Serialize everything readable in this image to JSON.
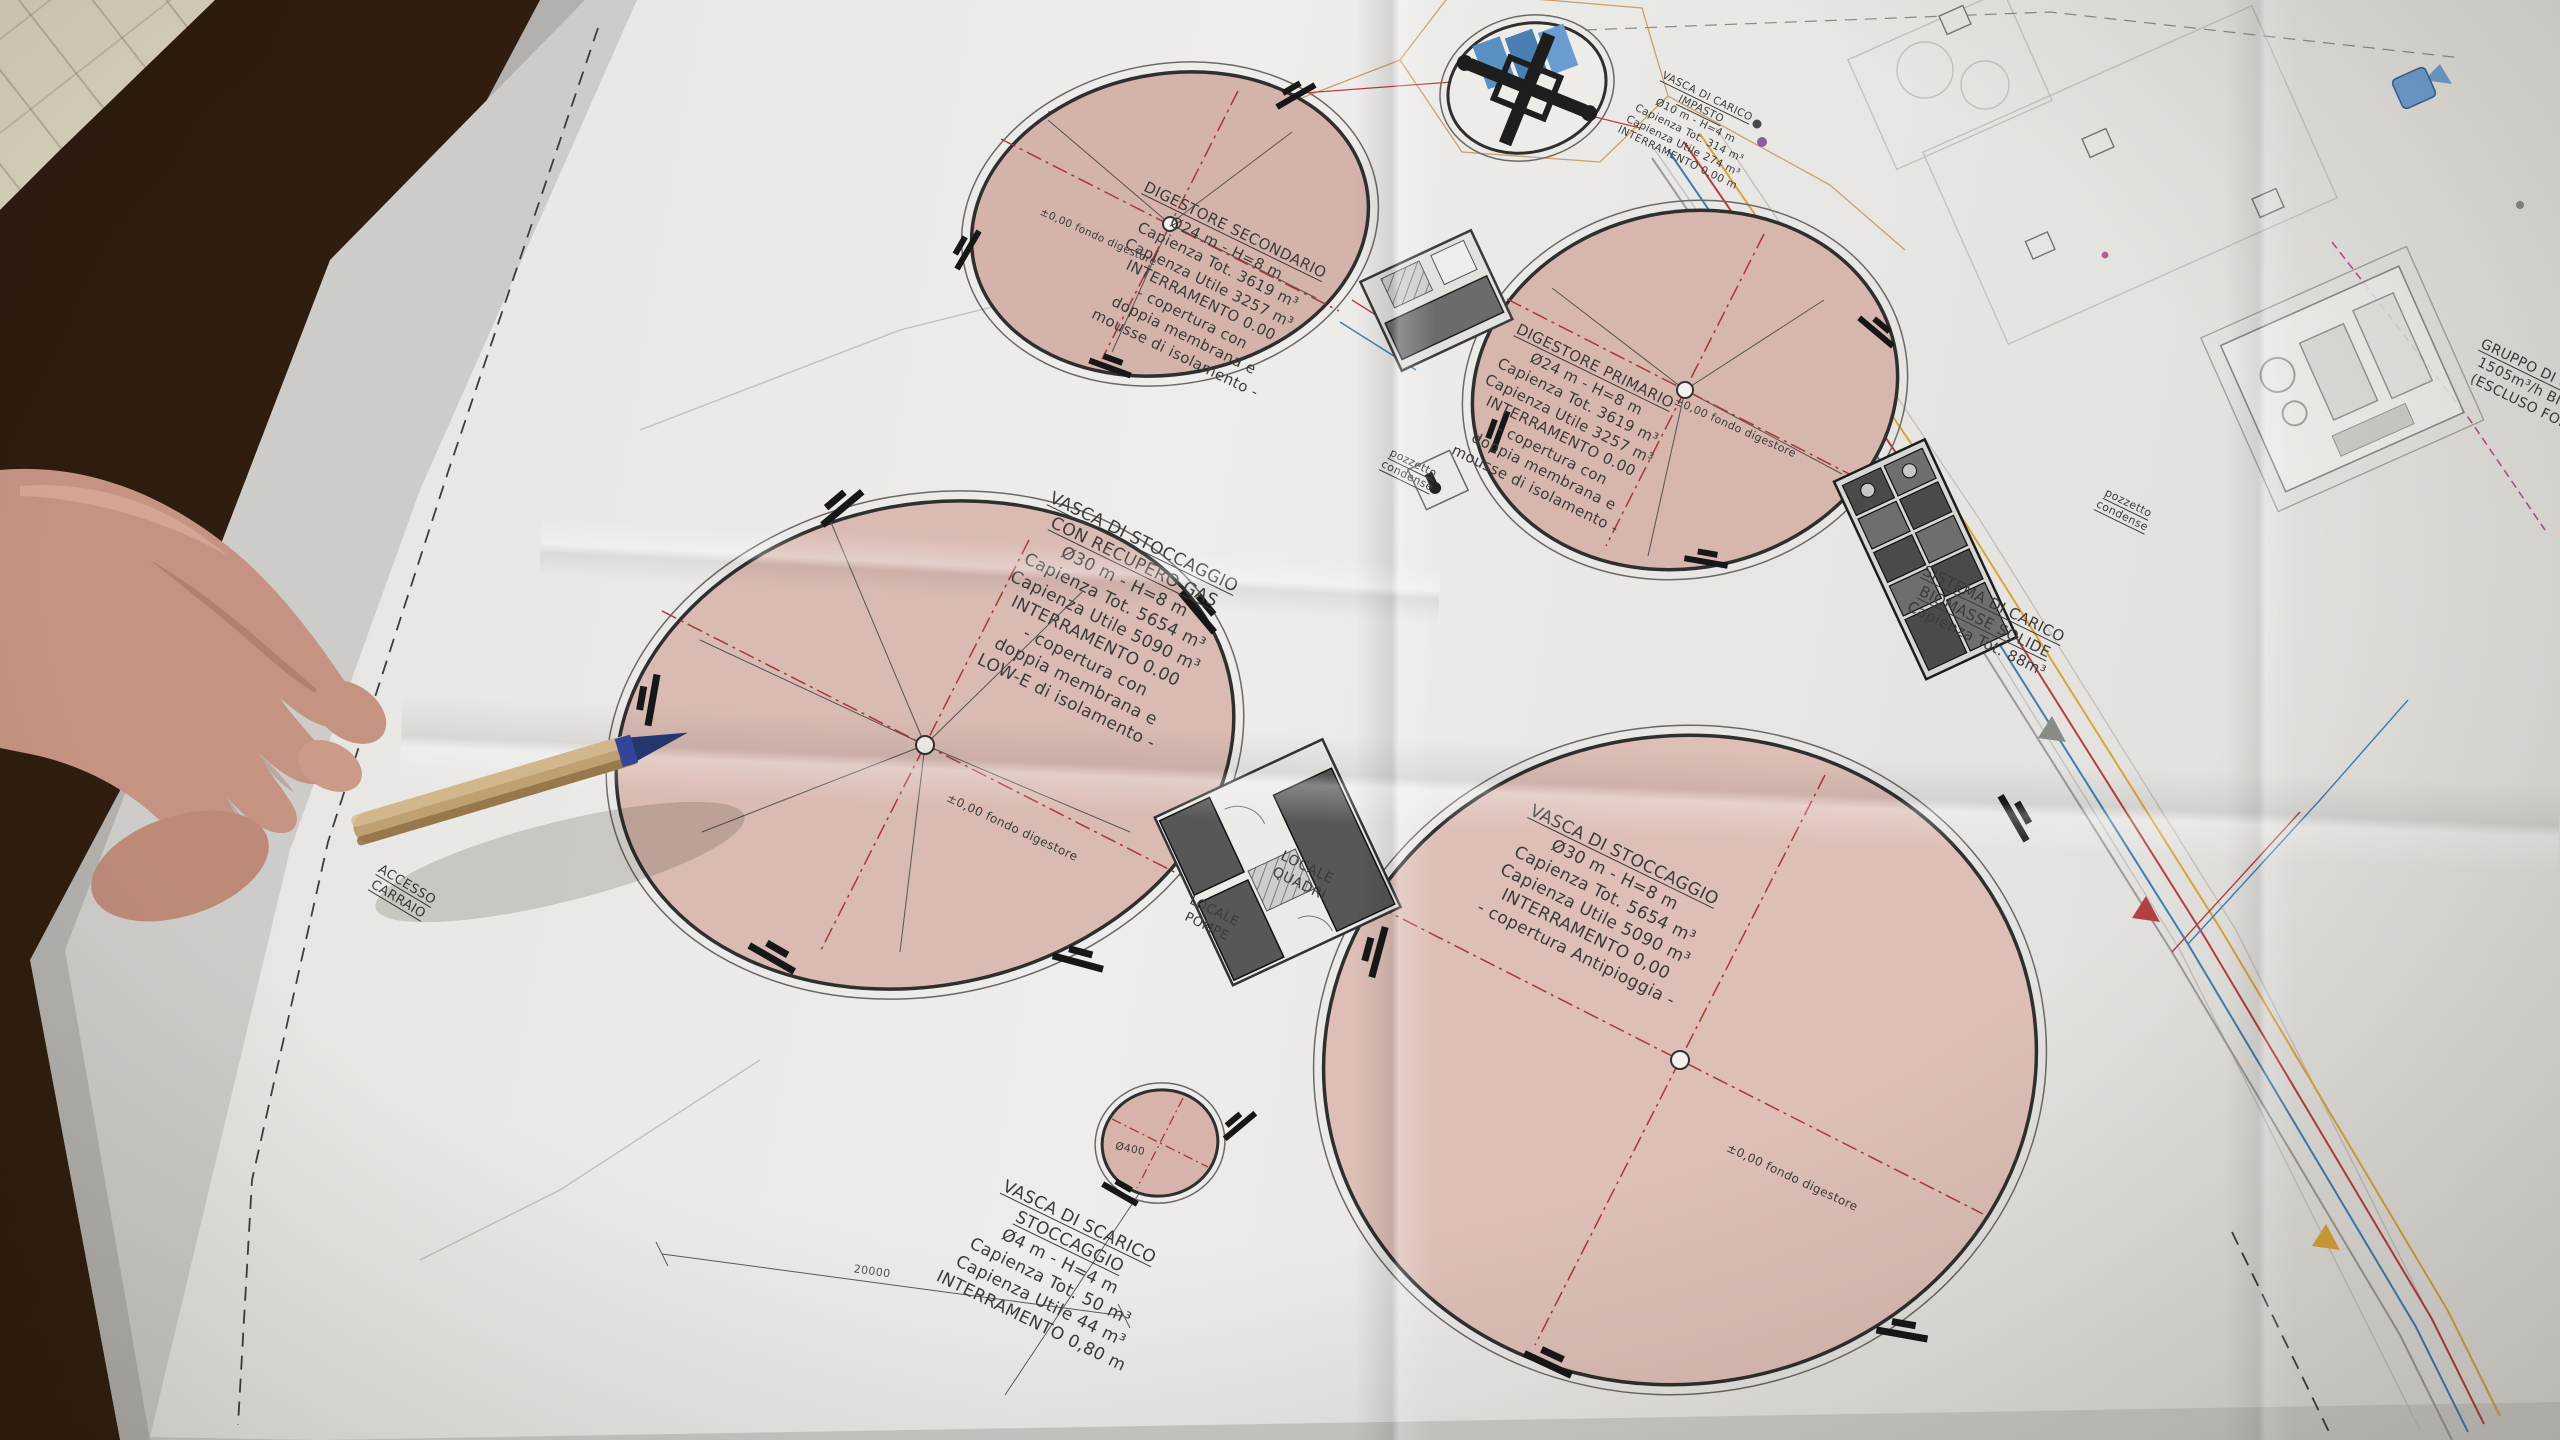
{
  "scene": {
    "description_labels": {
      "digestore_secondario": [
        "DIGESTORE SECONDARIO",
        "Ø24 m - H=8 m",
        "Capienza Tot. 3619 m³",
        "Capienza Utile 3257 m³",
        "INTERRAMENTO 0.00",
        "- copertura con",
        "doppia membrana e",
        "mousse di isolamento -"
      ],
      "digestore_primario": [
        "DIGESTORE PRIMARIO",
        "Ø24 m - H=8 m",
        "Capienza Tot. 3619 m³",
        "Capienza Utile 3257 m³",
        "INTERRAMENTO 0.00",
        "- copertura con",
        "doppia membrana e",
        "mousse di isolamento -"
      ],
      "vasca_stoccaggio_gas": [
        "VASCA DI STOCCAGGIO",
        "CON RECUPERO GAS",
        "Ø30 m - H=8 m",
        "Capienza Tot. 5654 m³",
        "Capienza Utile 5090 m³",
        "INTERRAMENTO 0.00",
        "- copertura con",
        "doppia membrana e",
        "LOW-E di isolamento -"
      ],
      "vasca_stoccaggio": [
        "VASCA DI STOCCAGGIO",
        "Ø30 m - H=8 m",
        "Capienza Tot. 5654 m³",
        "Capienza Utile 5090 m³",
        "INTERRAMENTO 0,00",
        "- copertura Antipioggia -"
      ],
      "vasca_scarico_stoccaggio": [
        "VASCA DI SCARICO",
        "STOCCAGGIO",
        "Ø4 m - H=4 m",
        "Capienza Tot. 50 m³",
        "Capienza Utile 44 m³",
        "INTERRAMENTO 0,80 m"
      ],
      "vasca_carico_impasto": [
        "VASCA DI CARICO",
        "IMPASTO",
        "Ø10 m - H=4 m",
        "Capienza Tot. 314 m³",
        "Capienza Utile 274 m³",
        "INTERRAMENTO 0,00 m"
      ],
      "sistema_carico": [
        "SISTEMA DI CARICO",
        "BIOMASSE SOLIDE",
        "Capienza Tot. 88m³"
      ],
      "gruppo_upgrading": [
        "GRUPPO DI UPGRADING",
        "1505m³/h BIOMETANO",
        "(ESCLUSO FORNITURA"
      ],
      "locale_quadri": [
        "LOCALE",
        "QUADRI"
      ],
      "locale_pompe": [
        "LOCALE",
        "POMPE"
      ],
      "pozzetto_condense": [
        "pozzetto",
        "condense"
      ],
      "accesso_carraio": [
        "ACCESSO",
        "CARRAIO"
      ],
      "fondo_digestore": "±0,00 fondo digestore",
      "diametro_400": "Ø400",
      "dim_20000": "20000"
    },
    "colors": {
      "paper": "#e9e7e3",
      "tank_fill": "#d8b7af",
      "crosshair_red": "#a83838",
      "pipe_blue": "#3d7fb5",
      "pipe_red": "#b34040",
      "pipe_yellow": "#d8a43c",
      "pipe_magenta": "#b05090",
      "panel_blue": "#5a8fc4",
      "pen_body": "#bfa072",
      "pen_tip": "#25356e",
      "fabric": "#d8d1bc",
      "wood": "#2b1a0f"
    }
  }
}
